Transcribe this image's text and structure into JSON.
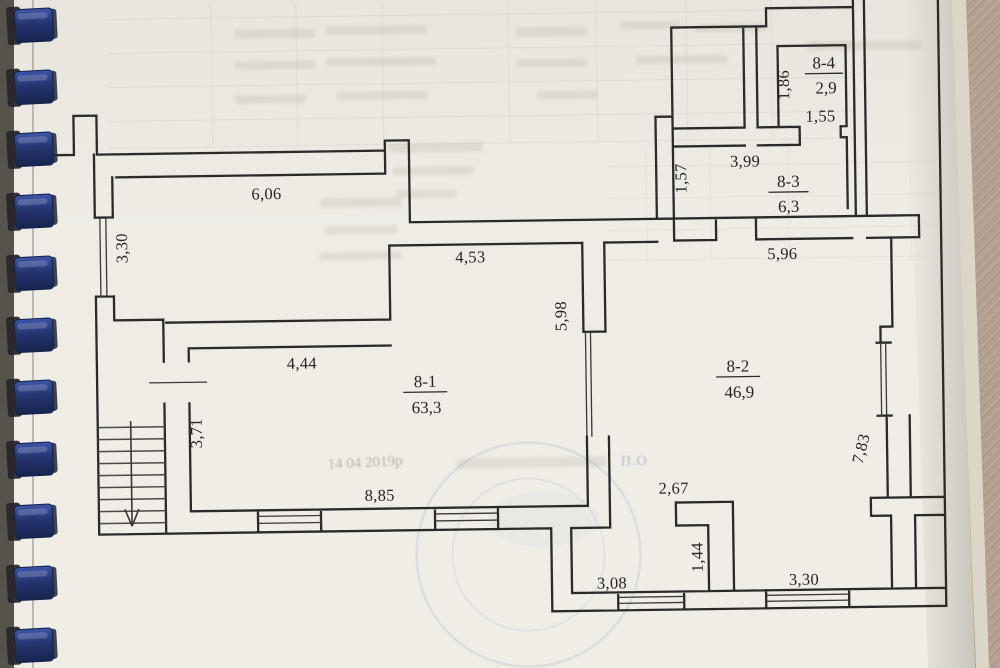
{
  "plan": {
    "rooms": {
      "r81": {
        "id": "8-1",
        "area": "63,3"
      },
      "r82": {
        "id": "8-2",
        "area": "46,9"
      },
      "r83": {
        "id": "8-3",
        "area": "6,3"
      },
      "r84": {
        "id": "8-4",
        "area": "2,9"
      }
    },
    "dims": {
      "hall_width": "6,06",
      "hall_window": "3,30",
      "upper_wall": "4,53",
      "divider_height": "5,98",
      "room81_top": "4,44",
      "room81_left": "3,71",
      "room81_bottom": "8,85",
      "wall_157": "1,57",
      "room83_width": "3,99",
      "room84_height": "1,86",
      "room84_door": "1,55",
      "wall_596": "5,96",
      "right_side": "7,83",
      "recess_width": "2,67",
      "recess_depth": "1,44",
      "window_left": "3,08",
      "window_right": "3,30"
    }
  },
  "stamp": {
    "date_text": "14 04 2019р",
    "bleed_mark": "П.О"
  },
  "binding": {
    "coil_count": 11,
    "coil_pitch": 62,
    "coil_color_top": "#31479098",
    "coil_color": "#24356f",
    "coil_color_dark": "#131f4a",
    "hole_color": "#26242a"
  },
  "colors": {
    "paper": "#efede7",
    "background": "#b3a08e",
    "wall_line": "#2b2a27"
  }
}
